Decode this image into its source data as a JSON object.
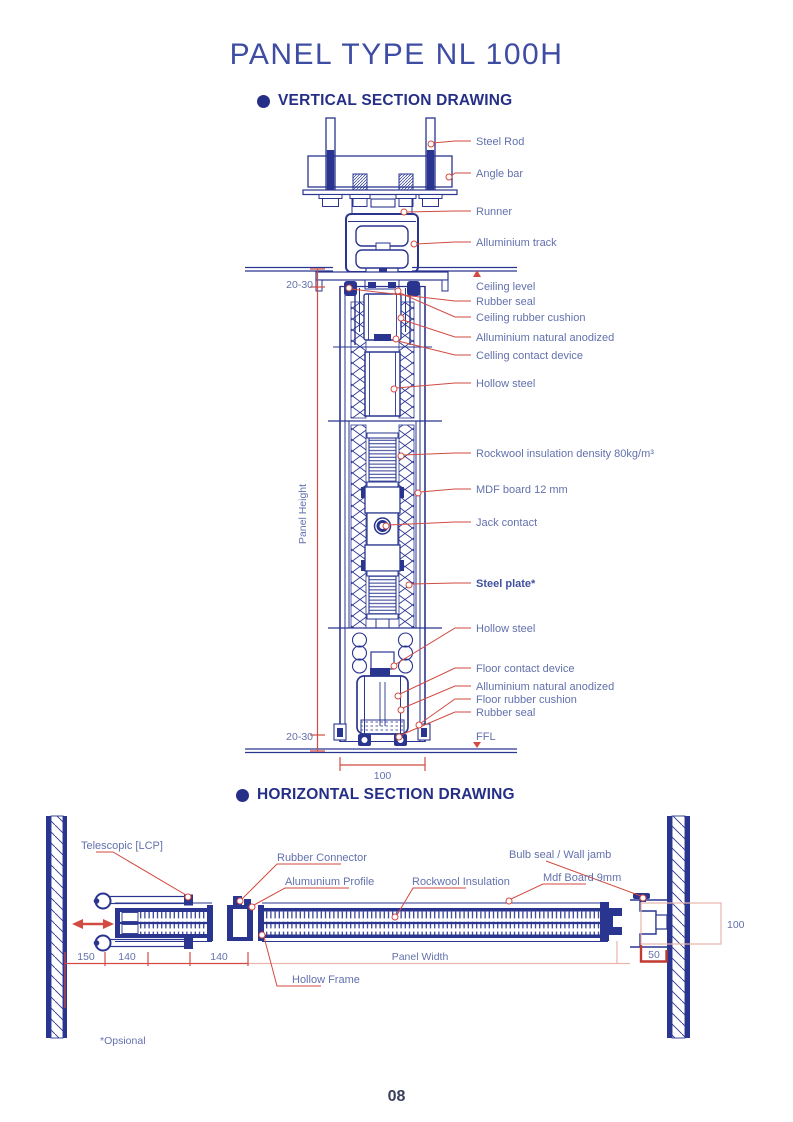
{
  "page": {
    "title": "PANEL TYPE NL 100H",
    "footnote": "*Opsional",
    "page_number": "08"
  },
  "colors": {
    "navy": "#2a3590",
    "heading_navy": "#262f87",
    "label_blue": "#6371ad",
    "leader_red": "#d14b42",
    "pale_red": "#eab3ab",
    "bracket_red": "#c13a30"
  },
  "vertical_section": {
    "heading": "VERTICAL SECTION DRAWING",
    "labels": {
      "steel_rod": "Steel Rod",
      "angle_bar": "Angle bar",
      "runner": "Runner",
      "alluminium_track": "Alluminium track",
      "ceiling_level": "Ceiling level",
      "rubber_seal_top": "Rubber seal",
      "ceiling_rubber_cushion": "Ceiling rubber cushion",
      "alluminium_natural_anodized_top": "Alluminium natural anodized",
      "celling_contact_device": "Celling contact device",
      "hollow_steel_top": "Hollow steel",
      "rockwool": "Rockwool insulation density 80kg/m³",
      "mdf_board": "MDF board 12 mm",
      "jack_contact": "Jack contact",
      "steel_plate": "Steel plate*",
      "hollow_steel_bottom": "Hollow steel",
      "floor_contact_device": "Floor contact device",
      "alluminium_natural_anodized_bottom": "Alluminium natural anodized",
      "floor_rubber_cushion": "Floor rubber cushion",
      "rubber_seal_bottom": "Rubber seal",
      "ffl": "FFL"
    },
    "dimensions": {
      "gap_top": "20-30",
      "gap_bottom": "20-30",
      "panel_height": "Panel Height",
      "panel_thickness": "100"
    }
  },
  "horizontal_section": {
    "heading": "HORIZONTAL SECTION DRAWING",
    "labels": {
      "telescopic": "Telescopic [LCP]",
      "rubber_connector": "Rubber Connector",
      "alumunium_profile": "Alumunium Profile",
      "rockwool_insulation": "Rockwool Insulation",
      "bulb_seal_wall_jamb": "Bulb seal / Wall jamb",
      "mdf_board": "Mdf Board 9mm",
      "hollow_frame": "Hollow Frame",
      "panel_width": "Panel Width"
    },
    "dimensions": {
      "left_offset": "150",
      "telescopic_width": "140",
      "connector_width": "140",
      "jamb_depth": "50",
      "panel_thickness": "100"
    }
  }
}
